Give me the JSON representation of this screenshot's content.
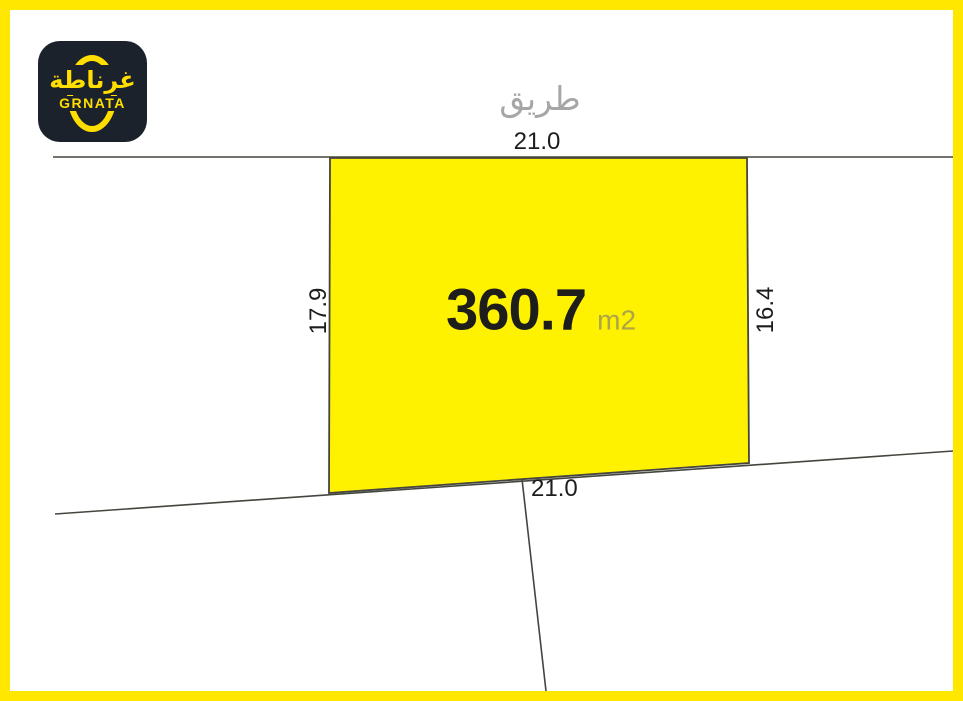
{
  "logo": {
    "arabic_name": "غرناطة",
    "latin_name": "GRNATA"
  },
  "road_label": "طريق",
  "plot": {
    "area_value": "360.7",
    "area_unit": "m2",
    "top_dim": "21.0",
    "left_dim": "17.9",
    "right_dim": "16.4",
    "bottom_dim": "21.0"
  },
  "colors": {
    "frame_yellow": "#ffe700",
    "plot_fill": "#fff200",
    "line": "#45453f",
    "text_dark": "#1d1d1b",
    "text_gray": "#a6a6a6",
    "unit_olive": "#aca448",
    "logo_bg": "#1b222c",
    "logo_yellow": "#ffde00"
  }
}
